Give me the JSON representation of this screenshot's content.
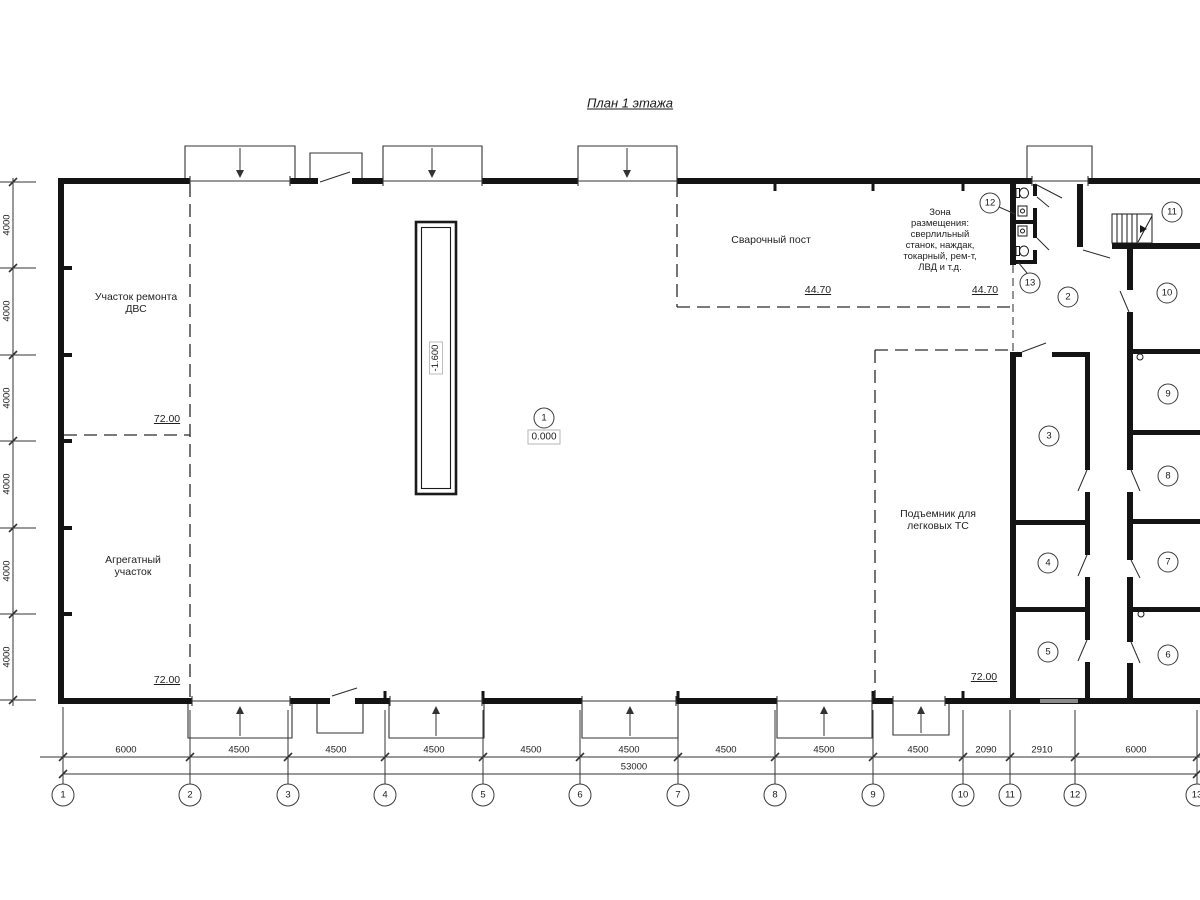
{
  "title": "План 1 этажа",
  "rooms": {
    "repair_line1": "Участок ремонта",
    "repair_line2": "ДВС",
    "aggregate_line1": "Агрегатный",
    "aggregate_line2": "участок",
    "welding": "Сварочный пост",
    "zone_lines": [
      "Зона",
      "размещения:",
      "сверлильный",
      "станок, наждак,",
      "токарный, рем-т,",
      "ЛВД и т.д."
    ],
    "lift_line1": "Подъемник для",
    "lift_line2": "легковых ТС"
  },
  "elevations": {
    "floor": "0.000",
    "pit": "-1.600",
    "level_72": "72.00",
    "level_4470": "44.70"
  },
  "room_numbers": [
    "1",
    "2",
    "3",
    "4",
    "5",
    "6",
    "7",
    "8",
    "9",
    "10",
    "11",
    "12",
    "13"
  ],
  "axes": [
    "1",
    "2",
    "3",
    "4",
    "5",
    "6",
    "7",
    "8",
    "9",
    "10",
    "11",
    "12",
    "13"
  ],
  "dimensions": {
    "bottom": [
      "6000",
      "4500",
      "4500",
      "4500",
      "4500",
      "4500",
      "4500",
      "4500",
      "4500",
      "2090",
      "2910",
      "6000"
    ],
    "total": "53000",
    "left_bay": "4000"
  }
}
